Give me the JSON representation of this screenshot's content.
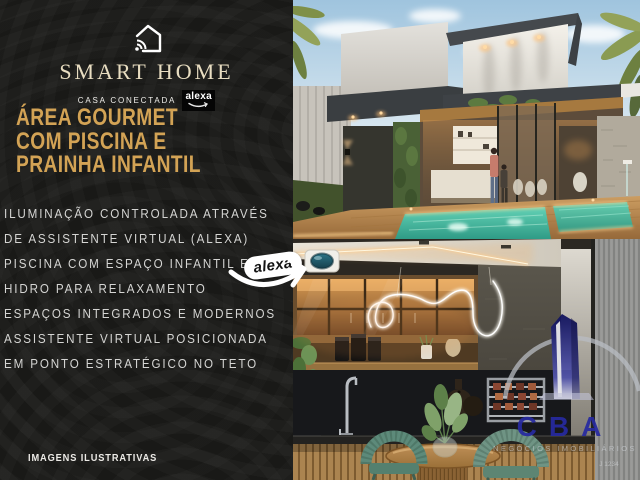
{
  "branding": {
    "title": "SMART HOME",
    "subtitle": "CASA CONECTADA",
    "alexa_badge_label": "alexa",
    "headline": [
      "ÁREA GOURMET",
      "COM PISCINA E",
      "PRAINHA INFANTIL"
    ]
  },
  "features": {
    "lines": [
      "ILUMINAÇÃO CONTROLADA ATRAVÉS",
      "DE ASSISTENTE VIRTUAL (ALEXA)",
      "PISCINA COM ESPAÇO INFANTIL E",
      "HIDRO PARA RELAXAMENTO",
      "ESPAÇOS INTEGRADOS E MODERNOS",
      "ASSISTENTE VIRTUAL POSICIONADA",
      "EM PONTO ESTRATÉGICO NO TETO"
    ]
  },
  "callout": {
    "label": "alexa"
  },
  "footer": {
    "disclaimer": "IMAGENS ILUSTRATIVAS"
  },
  "watermark": {
    "brand": "CBA",
    "tagline": "NEGÓCIOS IMOBILIÁRIOS",
    "registry": "J 1234"
  },
  "colors": {
    "panel_bg": "#191917",
    "gold": "#d3a355",
    "cream_title": "#e8ddc1",
    "cba_blue": "#272aa0",
    "pool_water": "#3fbfa6",
    "alexa_device_dome": "#2e7587"
  }
}
